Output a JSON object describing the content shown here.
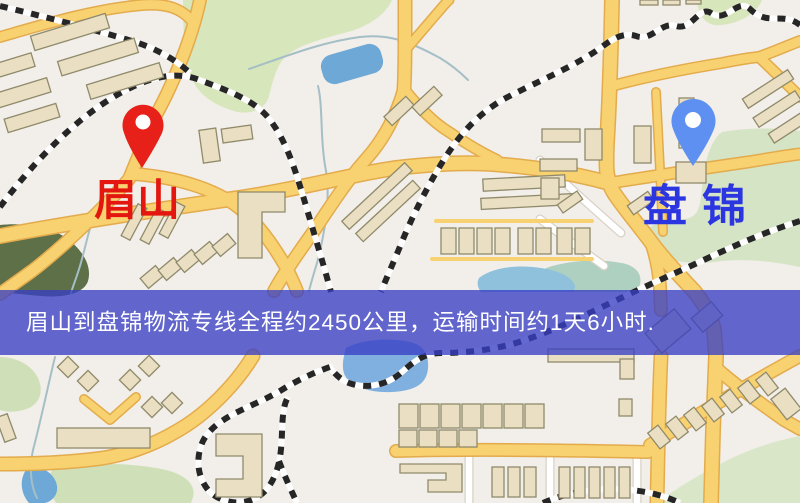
{
  "map": {
    "markers": {
      "origin": {
        "label": "眉山",
        "pin": "red-location-pin"
      },
      "destination": {
        "label": "盘锦",
        "pin": "blue-location-pin"
      }
    }
  },
  "banner": {
    "text": "眉山到盘锦物流专线全程约2450公里，运输时间约1天6小时."
  },
  "colors": {
    "origin_label": "#e3170f",
    "destination_label": "#2b35e0",
    "origin_pin": "#e8201a",
    "destination_pin": "#5d90f0",
    "banner_overlay": "rgba(56,63,196,0.78)",
    "banner_text": "#ffffff",
    "road": "#f8d170",
    "water": "#6ea8d6",
    "park_green": "#d7e6bb",
    "railway": "#262626",
    "background": "#f2eee9"
  }
}
